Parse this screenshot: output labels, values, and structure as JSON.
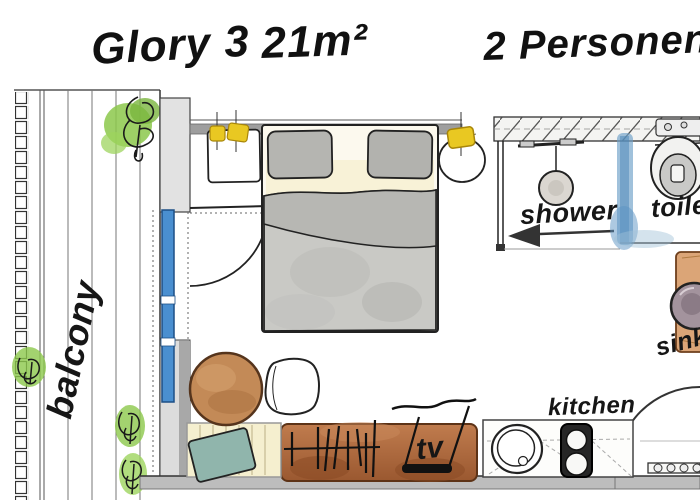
{
  "header": {
    "room_name": "Glory 3",
    "room_size": "21m²",
    "occupancy": "2 Personen"
  },
  "labels": {
    "balcony": "balcony",
    "shower": "shower",
    "toilet": "toilet",
    "sink": "sink",
    "kitchen": "kitchen",
    "tv": "tv"
  },
  "plan": {
    "type": "hand-drawn watercolor studio floor plan",
    "areas": [
      "balcony",
      "sleeping area",
      "shower",
      "toilet",
      "vanity sink",
      "kitchen",
      "living area",
      "entrance"
    ],
    "furniture": [
      "double bed",
      "two pillows",
      "duvet",
      "square nightstand with two lamps",
      "round nightstand with lamp",
      "bench with cushion",
      "round table",
      "chair",
      "sideboard with tv",
      "kitchen counter with round sink and two-burner stove",
      "sink cabinet",
      "three plants"
    ],
    "entry_arrow_direction": "left"
  },
  "icons": {
    "plant-icon": "green watercolor scribble",
    "lamp-icon": "yellow blob with cross lines",
    "shower-head-icon": "circle head hanging from rail",
    "arrow-left-icon": "solid black left triangle with shaft",
    "toilet-icon": "oval bowl with inner seat",
    "sink-icon": "circle with drain",
    "stove-icon": "black panel with two burner circles",
    "tv-icon": "antenna strokes over black bar",
    "door-swing-icon": "quarter-circle arc",
    "glass-partition-icon": "blue watercolor strip",
    "railing-icon": "stacked small rectangles"
  },
  "colors": {
    "plant_green": "#8cc84b",
    "door_blue": "#4a8fd0",
    "lamp_yellow": "#e9c822",
    "sideboard_brown": "#a9653c",
    "table_brown": "#c38a57",
    "bench_cream": "#f5efcf",
    "cushion_teal": "#90b5ac",
    "wall_gray": "#9e9e9e",
    "blanket_gray": "#c9c9c5",
    "glass_wash_blue": "#6d9fc7",
    "vanity_tan": "#dba577",
    "sink_mauve": "#a3939d",
    "ink_black": "#161616"
  }
}
